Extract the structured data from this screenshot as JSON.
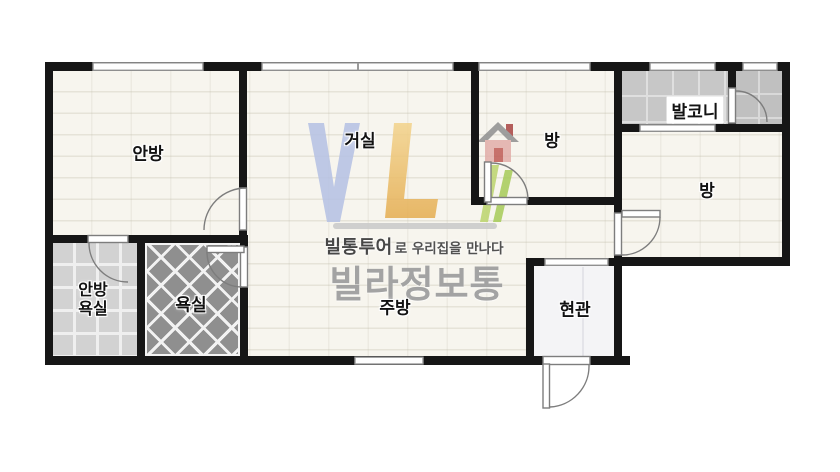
{
  "rooms": {
    "master_bedroom": "안방",
    "living_room": "거실",
    "room_top_center": "방",
    "room_right": "방",
    "balcony": "발코니",
    "master_bath_line1": "안방",
    "master_bath_line2": "욕실",
    "bathroom": "욕실",
    "kitchen": "주방",
    "entrance": "현관"
  },
  "watermark": {
    "brand_bold": "빌통투어",
    "slogan_tail": "로 우리집을 만나다",
    "brand_large": "빌라정보통"
  },
  "colors": {
    "wall": "#161616",
    "room_floor": "#f7f5ee",
    "balcony_tile": "#c7c7c7",
    "bathroom_tile": "#8f8f8f",
    "master_bath_tile": "#d2d2d2",
    "entrance_floor": "#f4f4f6",
    "logo_blue": "#b5c1e4",
    "logo_yellow": "#eec36d",
    "logo_green": "#aed065",
    "logo_red": "#bf5b55",
    "watermark_grey": "#a3a3a3"
  }
}
